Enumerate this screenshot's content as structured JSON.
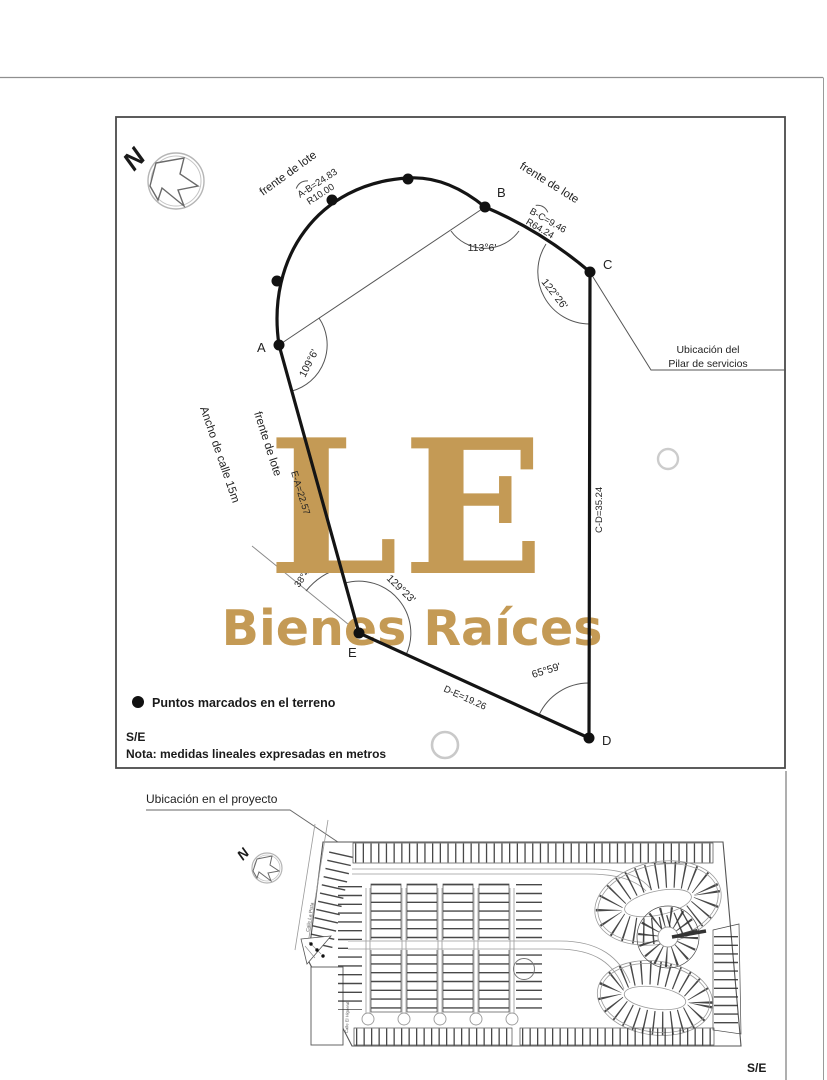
{
  "lot_plan": {
    "north_label": "N",
    "points": {
      "a": "A",
      "b": "B",
      "c": "C",
      "d": "D",
      "e": "E"
    },
    "sides": {
      "ab": {
        "frontage": "frente de lote",
        "length": "A-B=24.83",
        "radius": "R10.00"
      },
      "bc": {
        "frontage": "frente de lote",
        "length": "B-C=9.46",
        "radius": "R64.24"
      },
      "cd": {
        "length": "C-D=35.24"
      },
      "de": {
        "length": "D-E=19.26"
      },
      "ea": {
        "frontage": "frente de lote",
        "length": "E-A=22.57"
      }
    },
    "angles": {
      "a": "109°6'",
      "b": "113°6'",
      "c": "122°26'",
      "d": "65°59'",
      "e": "129°23'",
      "street": "38°4'"
    },
    "street_width_label": "Ancho de calle 15m",
    "service_pillar": {
      "line1": "Ubicación del",
      "line2": "Pilar de servicios"
    },
    "legend_marker_label": "Puntos marcados en el terreno",
    "scale_label": "S/E",
    "note": "Nota: medidas lineales expresadas en metros"
  },
  "watermark": {
    "initials": "LE",
    "brand": "Bienes Raíces",
    "color": "#c49a55"
  },
  "project_map": {
    "title": "Ubicación en el proyecto",
    "north_label": "N",
    "street_1": "Calle La Pista",
    "street_2": "Calle El Higueral",
    "scale_label": "S/E"
  },
  "colors": {
    "ink": "#1c1c1c",
    "line_gray": "#8a8a8a",
    "watermark_gold": "#c49a55"
  }
}
